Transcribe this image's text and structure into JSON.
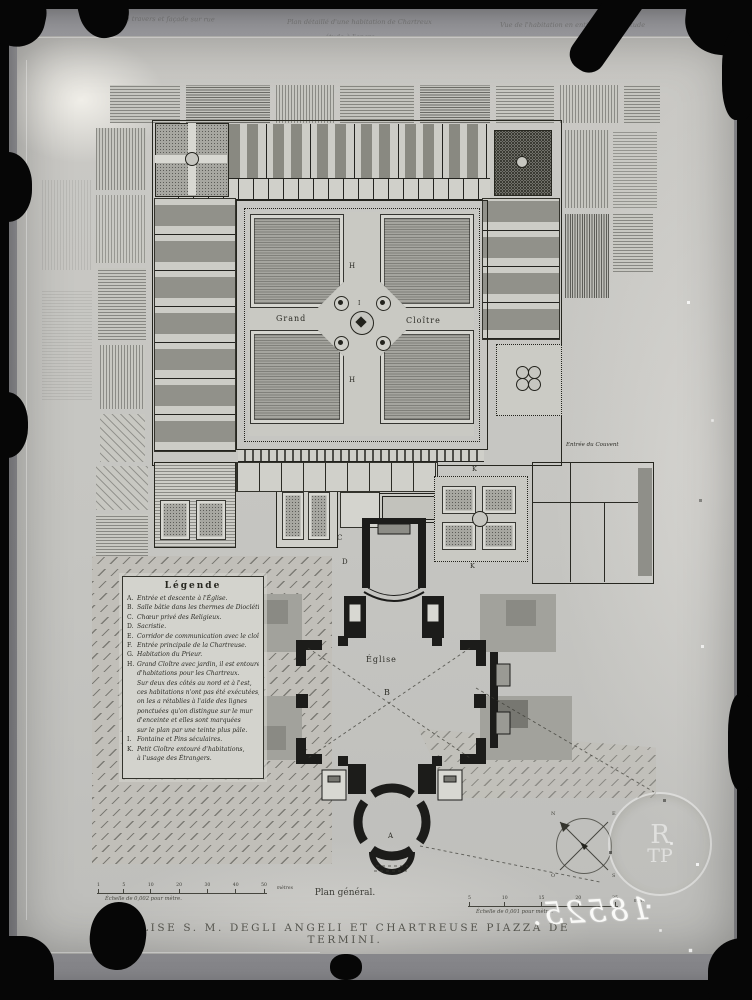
{
  "colors": {
    "frame": "#060606",
    "mat": "#8e8e92",
    "plate": "#c7c7c3",
    "ink": "#26261f",
    "poche": "#1c1c1a",
    "stipple": "#a5a59f",
    "wash": "#c1bfb9",
    "handwriting_white": "#fcfcfa"
  },
  "top_annotations": {
    "left": "Coupe en travers et façade sur rue",
    "center_line1": "Plan détaillé d'une habitation de Chartreux",
    "center_line2": "étude à l'encre",
    "right": "Vue de l'habitation en entier, mise à l'étude"
  },
  "plan": {
    "labels": {
      "grand": "Grand",
      "cloitre": "Cloître",
      "h_top": "H",
      "h_bottom": "H",
      "i_fountain": "I",
      "eglise": "Église",
      "b_nave": "B",
      "a_entrance": "A",
      "c_choir": "C",
      "d_sacristie": "D",
      "k_top": "K",
      "k_bottom": "K",
      "entree_couvent": "Entrée du Couvent"
    }
  },
  "legend": {
    "title": "Légende",
    "items": [
      {
        "k": "A.",
        "t": "Entrée et descente à l'Église."
      },
      {
        "k": "B.",
        "t": "Salle bâtie dans les thermes de Dioclétien."
      },
      {
        "k": "C.",
        "t": "Chœur privé des Religieux."
      },
      {
        "k": "D.",
        "t": "Sacristie."
      },
      {
        "k": "E.",
        "t": "Corridor de communication avec le cloître."
      },
      {
        "k": "F.",
        "t": "Entrée principale de la Chartreuse."
      },
      {
        "k": "G.",
        "t": "Habitation du Prieur."
      },
      {
        "k": "H.",
        "t": "Grand Cloître avec jardin, il est entouré"
      },
      {
        "k": "",
        "t": "d'habitations pour les Chartreux."
      },
      {
        "k": "",
        "t": "Sur deux des côtés au nord et à l'est,"
      },
      {
        "k": "",
        "t": "ces habitations n'ont pas été exécutées,"
      },
      {
        "k": "",
        "t": "on les a rétablies à l'aide des lignes"
      },
      {
        "k": "",
        "t": "ponctuées qu'on distingue sur le mur"
      },
      {
        "k": "",
        "t": "d'enceinte et elles sont marquées"
      },
      {
        "k": "",
        "t": "sur le plan par une teinte plus pâle."
      },
      {
        "k": "I.",
        "t": "Fontaine et Pins séculaires."
      },
      {
        "k": "K.",
        "t": "Petit Cloître entouré d'habitations,"
      },
      {
        "k": "",
        "t": "à l'usage des Étrangers."
      }
    ]
  },
  "scale_left": {
    "ticks": [
      "1",
      "5",
      "10",
      "20",
      "30",
      "40",
      "50"
    ],
    "unit": "mètres",
    "caption": "Échelle de 0,002 pour mètre."
  },
  "scale_right": {
    "ticks": [
      "5",
      "10",
      "15",
      "20",
      "25"
    ],
    "unit": "mèt.",
    "caption": "Échelle de 0,001 pour mètre."
  },
  "captions": {
    "plan_general": "Plan général.",
    "title": "ÉGLISE S. M. DEGLI ANGELI ET CHARTREUSE PIAZZA DE TERMINI."
  },
  "plate_number_mirrored": "18525.",
  "compass": {
    "nw": "N",
    "ne": "E",
    "sw": "O",
    "se": "S"
  },
  "stamp": {
    "top": "R",
    "bottom": "TP"
  }
}
